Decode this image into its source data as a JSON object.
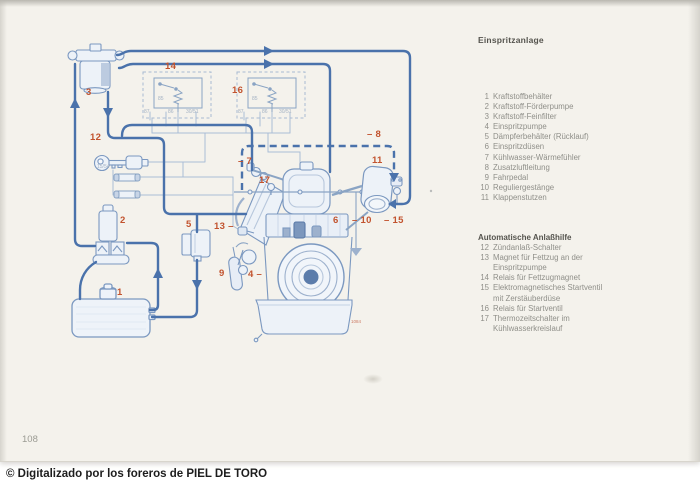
{
  "page": {
    "number": "108",
    "watermark": "© Digitalizado por los foreros de PIEL DE TORO"
  },
  "legend": {
    "title": "Einspritzanlage",
    "items": [
      {
        "n": "1",
        "label": "Kraftstoffbehälter"
      },
      {
        "n": "2",
        "label": "Kraftstoff-Förderpumpe"
      },
      {
        "n": "3",
        "label": "Kraftstoff-Feinfilter"
      },
      {
        "n": "4",
        "label": "Einspritzpumpe"
      },
      {
        "n": "5",
        "label": "Dämpferbehälter (Rücklauf)"
      },
      {
        "n": "6",
        "label": "Einspritzdüsen"
      },
      {
        "n": "7",
        "label": "Kühlwasser-Wärmefühler"
      },
      {
        "n": "8",
        "label": "Zusatzluftleitung"
      },
      {
        "n": "9",
        "label": "Fahrpedal"
      },
      {
        "n": "10",
        "label": "Reguliergestänge"
      },
      {
        "n": "11",
        "label": "Klappenstutzen"
      }
    ],
    "section2_title": "Automatische Anlaßhilfe",
    "items2": [
      {
        "n": "12",
        "label": "Zündanlaß-Schalter"
      },
      {
        "n": "13",
        "label": "Magnet für Fettzug an der\nEinspritzpumpe"
      },
      {
        "n": "14",
        "label": "Relais für Fettzugmagnet"
      },
      {
        "n": "15",
        "label": "Elektromagnetisches Startventil\nmit Zerstäuberdüse"
      },
      {
        "n": "16",
        "label": "Relais für Startventil"
      },
      {
        "n": "17",
        "label": "Thermozeitschalter im\nKühlwasserkreislauf"
      }
    ]
  },
  "diagram": {
    "colors": {
      "line_blue": "#4a72ab",
      "component_blue": "#7b98c0",
      "label_red": "#c2532e"
    },
    "part_labels": [
      {
        "text": "3",
        "x": 86,
        "y": 88
      },
      {
        "text": "14",
        "x": 165,
        "y": 62
      },
      {
        "text": "16",
        "x": 232,
        "y": 86
      },
      {
        "text": "12",
        "x": 90,
        "y": 133
      },
      {
        "text": "2",
        "x": 120,
        "y": 216
      },
      {
        "text": "5",
        "x": 186,
        "y": 220
      },
      {
        "text": "1",
        "x": 117,
        "y": 288
      },
      {
        "text": "13 –",
        "x": 214,
        "y": 222
      },
      {
        "text": "9",
        "x": 219,
        "y": 269
      },
      {
        "text": "4 –",
        "x": 248,
        "y": 270
      },
      {
        "text": "– 7",
        "x": 238,
        "y": 157
      },
      {
        "text": "17",
        "x": 259,
        "y": 176
      },
      {
        "text": "– 8",
        "x": 367,
        "y": 130
      },
      {
        "text": "11",
        "x": 372,
        "y": 156
      },
      {
        "text": "6",
        "x": 333,
        "y": 216
      },
      {
        "text": "– 10",
        "x": 352,
        "y": 216
      },
      {
        "text": "– 15",
        "x": 384,
        "y": 216
      },
      {
        "text": "1084",
        "x": 351,
        "y": 317,
        "cls": "tiny"
      }
    ],
    "terminal_labels": [
      {
        "text": "87",
        "x": 144,
        "y": 110
      },
      {
        "text": "85",
        "x": 158,
        "y": 97
      },
      {
        "text": "86",
        "x": 168,
        "y": 110
      },
      {
        "text": "30/51",
        "x": 186,
        "y": 110
      },
      {
        "text": "87",
        "x": 238,
        "y": 110
      },
      {
        "text": "85",
        "x": 252,
        "y": 97
      },
      {
        "text": "86",
        "x": 262,
        "y": 110
      },
      {
        "text": "30/51",
        "x": 279,
        "y": 110
      },
      {
        "text": "15/54",
        "x": 97,
        "y": 165
      }
    ]
  }
}
